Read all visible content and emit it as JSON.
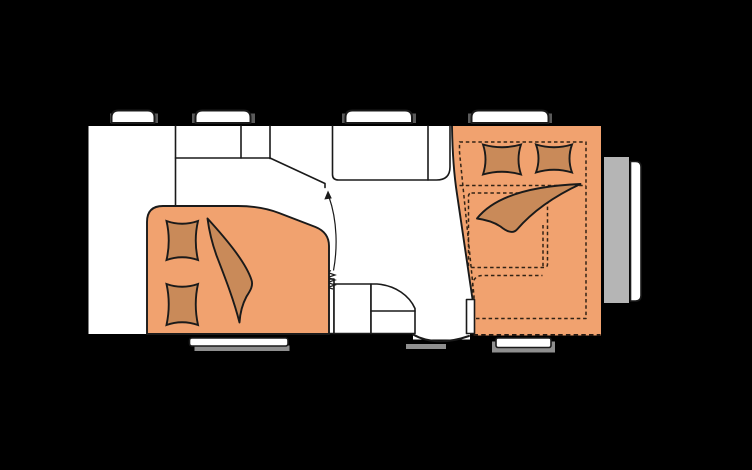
{
  "diagram": {
    "type": "caravan-floor-plan",
    "orientation": "side-profile-top-view",
    "parts": {
      "body": "caravan-body",
      "floor": "interior-floor",
      "top_windows": [
        "window-top-1",
        "window-top-2",
        "window-top-3",
        "window-top-4"
      ],
      "bottom_windows": [
        "window-bottom-rear",
        "window-bottom-front"
      ],
      "door": "entrance-door",
      "rear_bed": "french-bed-rear",
      "front_bed": "transverse-bed-front",
      "bed_extension": "bed-extension-dashed-outline",
      "pillows": "pillow",
      "duvet": "duvet",
      "kitchen": "kitchen-counter",
      "fridge": "fridge-section",
      "cabinet": "overhead-cabinet",
      "wardrobe": "corner-wardrobe",
      "washroom": "washroom-unit",
      "heater": "heater-coil-symbol",
      "arrow": "entrance-direction-arrow",
      "partition": "partition-wall",
      "front_panel": "front-storage-panel",
      "bumper": "front-bumper"
    }
  },
  "colors": {
    "background": "#000000",
    "wall": "#000000",
    "floor": "#ffffff",
    "bed": "#f1a26f",
    "bedding": "#c98a59",
    "outline": "#1a1a1a",
    "window_seal": "#5a5a5a",
    "window_shadow": "#8f8f8f",
    "side_panel": "#b5b5b5"
  }
}
